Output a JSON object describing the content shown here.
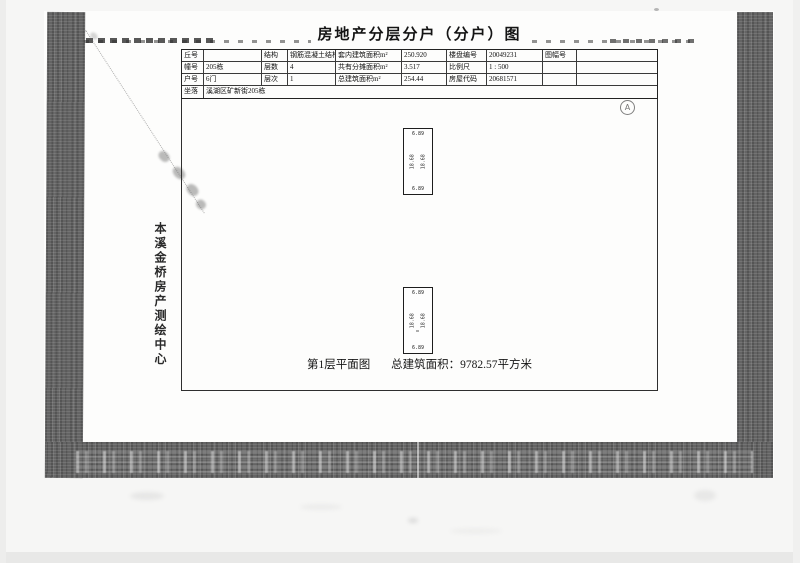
{
  "document": {
    "title": "房地产分层分户（分户）图",
    "table": {
      "rows": [
        {
          "c1": "丘号",
          "c2": "",
          "c3": "结构",
          "c4": "钢筋混凝土结构",
          "c5": "套内建筑面积m²",
          "c6": "250.920",
          "c7": "楼盘编号",
          "c8": "20049231",
          "c9": "图幅号",
          "c10": ""
        },
        {
          "c1": "幢号",
          "c2": "205栋",
          "c3": "层数",
          "c4": "4",
          "c5": "共有分摊面积m²",
          "c6": "3.517",
          "c7": "比例尺",
          "c8": "1 : 500",
          "c9": "",
          "c10": ""
        },
        {
          "c1": "户号",
          "c2": "6门",
          "c3": "层次",
          "c4": "1",
          "c5": "总建筑面积m²",
          "c6": "254.44",
          "c7": "房屋代码",
          "c8": "20681571",
          "c9": "",
          "c10": ""
        }
      ],
      "address_label": "坐落",
      "address_value": "溪湖区矿新街205栋"
    },
    "plan": {
      "north_symbol": "A",
      "units": [
        {
          "top": "6.89",
          "side_left": "18.68",
          "side_right": "18.68",
          "bottom": "6.89"
        },
        {
          "top": "6.89",
          "side_left": "18.68",
          "side_right": "18.68",
          "bottom": "6.89"
        }
      ],
      "caption_left": "第1层平面图",
      "caption_right": "总建筑面积：9782.57平方米"
    },
    "side_label": "本溪金桥房产测绘中心"
  }
}
